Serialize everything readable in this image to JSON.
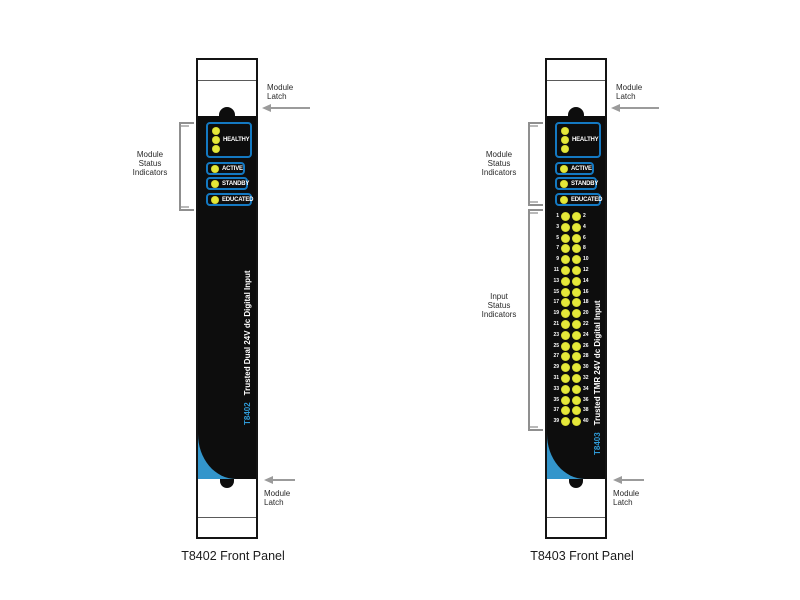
{
  "panels": [
    {
      "model": "T8402",
      "description": "Trusted Dual 24V dc Digital Input",
      "caption": "T8402 Front Panel",
      "status_leds": [
        "HEALTHY",
        "ACTIVE",
        "STANDBY",
        "EDUCATED"
      ]
    },
    {
      "model": "T8403",
      "description": "Trusted TMR 24V dc Digital Input",
      "caption": "T8403 Front Panel",
      "status_leds": [
        "HEALTHY",
        "ACTIVE",
        "STANDBY",
        "EDUCATED"
      ],
      "input_led_numbers": [
        [
          1,
          2
        ],
        [
          3,
          4
        ],
        [
          5,
          6
        ],
        [
          7,
          8
        ],
        [
          9,
          10
        ],
        [
          11,
          12
        ],
        [
          13,
          14
        ],
        [
          15,
          16
        ],
        [
          17,
          18
        ],
        [
          19,
          20
        ],
        [
          21,
          22
        ],
        [
          23,
          24
        ],
        [
          25,
          26
        ],
        [
          27,
          28
        ],
        [
          29,
          30
        ],
        [
          31,
          32
        ],
        [
          33,
          34
        ],
        [
          35,
          36
        ],
        [
          37,
          38
        ],
        [
          39,
          40
        ]
      ]
    }
  ],
  "annotations": {
    "module_latch_line1": "Module",
    "module_latch_line2": "Latch",
    "module_status_line1": "Module",
    "module_status_line2": "Status",
    "module_status_line3": "Indicators",
    "input_status_line1": "Input",
    "input_status_line2": "Status",
    "input_status_line3": "Indicators"
  },
  "colors": {
    "led_yellow": "#e5e83a",
    "box_border_blue": "#1479c2",
    "corner_blue": "#3395cb",
    "model_text_blue": "#2f9ad6",
    "arrow_gray": "#9b9b9b",
    "panel_black": "#0d0d0d"
  }
}
